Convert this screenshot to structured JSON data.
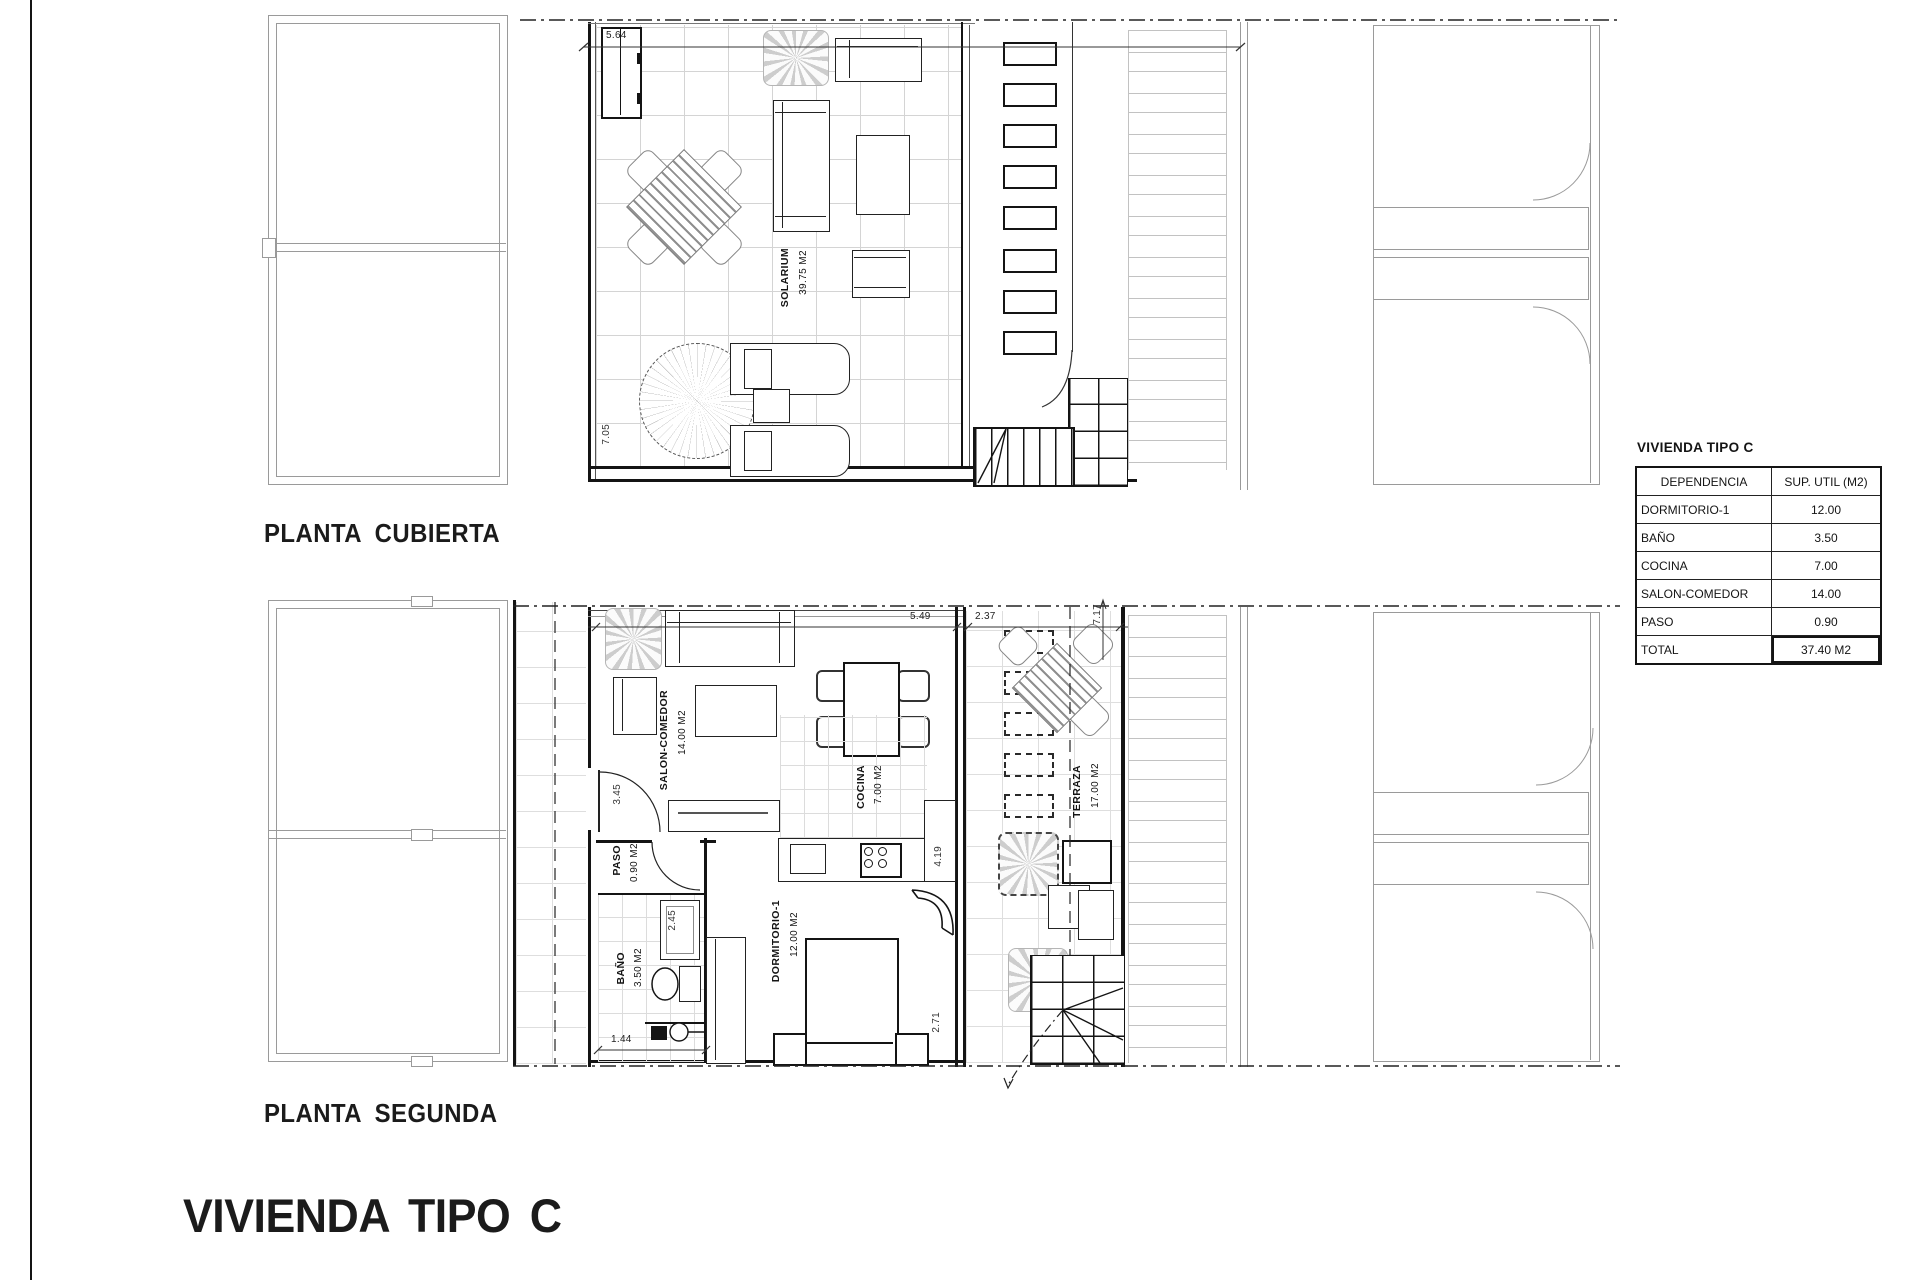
{
  "sheet": {
    "title": "VIVIENDA TIPO C",
    "plan_top_label": "PLANTA CUBIERTA",
    "plan_bottom_label": "PLANTA SEGUNDA"
  },
  "plan_cubierta": {
    "solarium_name": "SOLARIUM",
    "solarium_area": "39.75 M2",
    "dim_top": "5.64",
    "dim_left": "7.05"
  },
  "plan_segunda": {
    "salon_name": "SALON-COMEDOR",
    "salon_area": "14.00 M2",
    "cocina_name": "COCINA",
    "cocina_area": "7.00 M2",
    "terraza_name": "TERRAZA",
    "terraza_area": "17.00 M2",
    "dormitorio_name": "DORMITORIO-1",
    "dormitorio_area": "12.00 M2",
    "bano_name": "BAÑO",
    "bano_area": "3.50 M2",
    "paso_name": "PASO",
    "paso_area": "0.90 M2",
    "dim_width_main": "5.49",
    "dim_width_terraza": "2.37",
    "dim_terraza_depth": "7.17",
    "dim_salon": "3.45",
    "dim_bano_interior": "2.45",
    "dim_bano_width": "1.44",
    "dim_cocina": "4.19",
    "dim_dormitorio": "2.71"
  },
  "summary_table": {
    "title": "VIVIENDA TIPO C",
    "header": {
      "col1": "DEPENDENCIA",
      "col2": "SUP. UTIL (M2)"
    },
    "rows": [
      {
        "name": "DORMITORIO-1",
        "value": "12.00"
      },
      {
        "name": "BAÑO",
        "value": "3.50"
      },
      {
        "name": "COCINA",
        "value": "7.00"
      },
      {
        "name": "SALON-COMEDOR",
        "value": "14.00"
      },
      {
        "name": "PASO",
        "value": "0.90"
      },
      {
        "name": "TOTAL",
        "value": "37.40 M2"
      }
    ]
  }
}
